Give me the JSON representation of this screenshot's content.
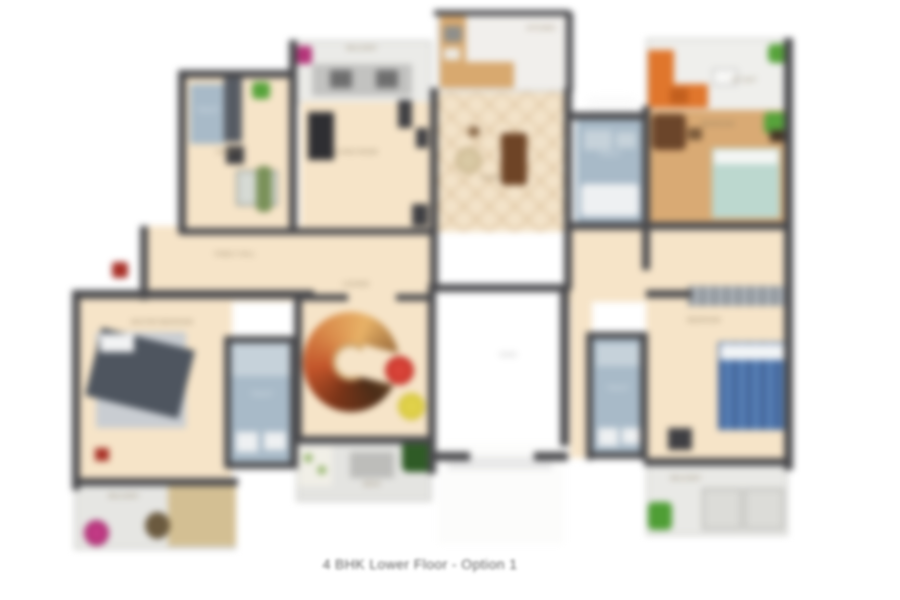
{
  "caption": "4 BHK Lower Floor - Option 1",
  "colors": {
    "wall": "#4a4a4d",
    "floor": "#f6e4c8",
    "wood_floor": "#d9aa74",
    "bathroom": "#a8bac8",
    "terrace": "#ebebe8",
    "bed_blue": "#4f76ac",
    "bed_teal": "#bcd8cf",
    "sofa_orange": "#e0762c",
    "stair_table_red": "#c32a22",
    "stool_yellow": "#d4c42e",
    "plant_green": "#57a33b",
    "planter_magenta": "#a8246b"
  },
  "rooms": {
    "toilet_top_left": {
      "label": "Toilet"
    },
    "dining": {
      "label": "Dining"
    },
    "balcony_top": {
      "label": "Balcony"
    },
    "living": {
      "label": "Living Room"
    },
    "kitchen": {
      "label": "Kitchen"
    },
    "foyer": {
      "label": "Foyer"
    },
    "toilet_top_right": {
      "label": "Toilet"
    },
    "sitout_top_right": {
      "label": "Sit Out"
    },
    "bedroom_top_right": {
      "label": "Bedroom"
    },
    "family_hall": {
      "label": "Family Hall"
    },
    "bedroom_left": {
      "label": "Master Bedroom"
    },
    "toilet_left": {
      "label": "Toilet"
    },
    "lounge": {
      "label": "Lounge"
    },
    "void": {
      "label": "Void"
    },
    "toilet_right": {
      "label": "Toilet"
    },
    "bedroom_right": {
      "label": "Bedroom"
    },
    "balcony_bottom_left": {
      "label": "Balcony"
    },
    "deck_bottom": {
      "label": "Deck"
    },
    "balcony_bottom_right": {
      "label": "Balcony"
    }
  }
}
